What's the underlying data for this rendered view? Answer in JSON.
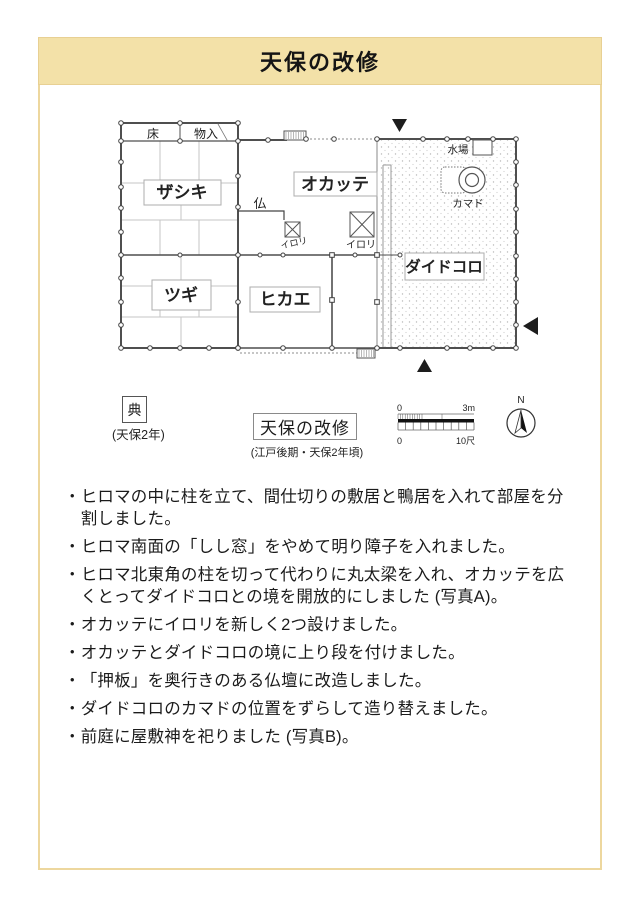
{
  "header": {
    "title": "天保の改修"
  },
  "plan": {
    "room_labels": {
      "zashiki": "ザシキ",
      "okatte": "オカッテ",
      "tsugi": "ツギ",
      "hikae": "ヒカエ",
      "daidokoro": "ダイドコロ"
    },
    "feature_labels": {
      "toko": "床",
      "monoire": "物入",
      "butsu": "仏",
      "irori_small": "イロリ",
      "irori_large": "イロリ",
      "mizuba": "水場",
      "kamado": "カマド"
    }
  },
  "legend": {
    "mark_char": "典",
    "mark_caption": "(天保2年)",
    "plan_name": "天保の改修",
    "plan_caption": "(江戸後期・天保2年頃)",
    "scale": {
      "top_left": "0",
      "top_right": "3m",
      "bottom_left": "0",
      "bottom_right": "10尺"
    },
    "compass_n": "N"
  },
  "notes": {
    "marker": "・",
    "items": [
      "ヒロマの中に柱を立て、間仕切りの敷居と鴨居を入れて部屋を分割しました。",
      "ヒロマ南面の「しし窓」をやめて明り障子を入れました。",
      "ヒロマ北東角の柱を切って代わりに丸太梁を入れ、オカッテを広くとってダイドコロとの境を開放的にしました (写真A)。",
      "オカッテにイロリを新しく2つ設けました。",
      "オカッテとダイドコロの境に上り段を付けました。",
      "「押板」を奥行きのある仏壇に改造しました。",
      "ダイドコロのカマドの位置をずらして造り替えました。",
      "前庭に屋敷神を祀りました (写真B)。"
    ]
  }
}
